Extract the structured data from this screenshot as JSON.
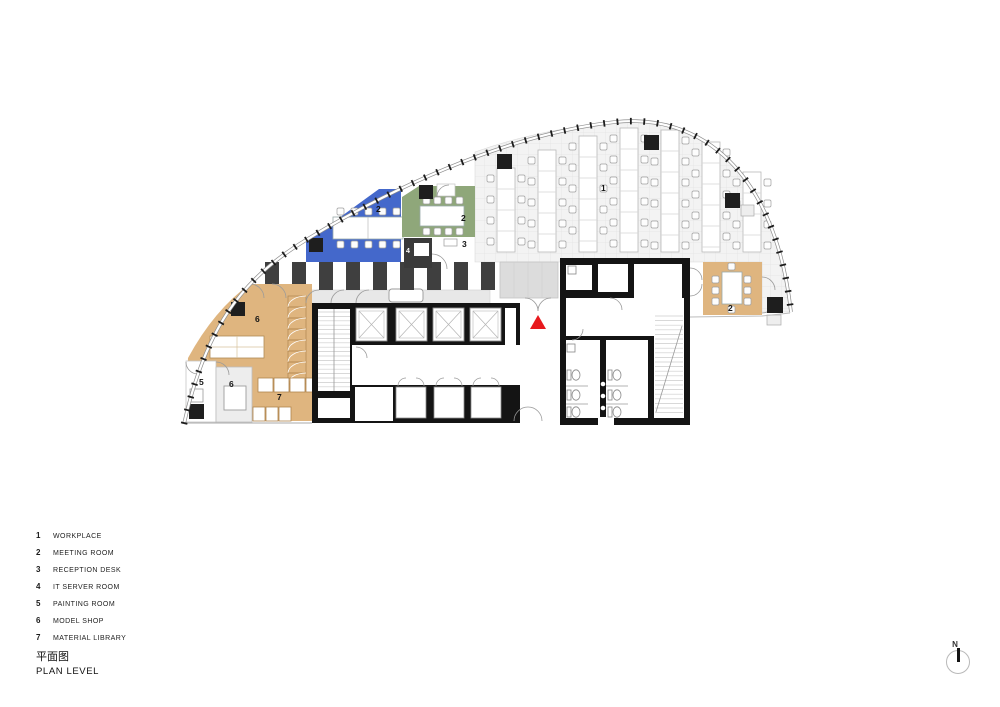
{
  "title": {
    "zh": "平面图",
    "en": "PLAN LEVEL"
  },
  "north_label": "N",
  "legend": {
    "items": [
      {
        "num": "1",
        "label": "WORKPLACE"
      },
      {
        "num": "2",
        "label": "MEETING ROOM"
      },
      {
        "num": "3",
        "label": "RECEPTION DESK"
      },
      {
        "num": "4",
        "label": "IT SERVER ROOM"
      },
      {
        "num": "5",
        "label": "PAINTING ROOM"
      },
      {
        "num": "6",
        "label": "MODEL SHOP"
      },
      {
        "num": "7",
        "label": "MATERIAL LIBRARY"
      }
    ]
  },
  "plan": {
    "labels": {
      "workplace": "1",
      "meeting": "2",
      "reception": "3",
      "it_server": "4",
      "painting": "5",
      "model_shop": "6",
      "material": "7"
    }
  },
  "colors": {
    "meeting_blue": "#4468CB",
    "meeting_green": "#8FA77A",
    "room_tan": "#DFB57F",
    "stripe_dark": "#3F3F3F",
    "wall_black": "#141414",
    "entry_marker_red": "#E8191D",
    "office_floor": "#F3F3F3"
  }
}
